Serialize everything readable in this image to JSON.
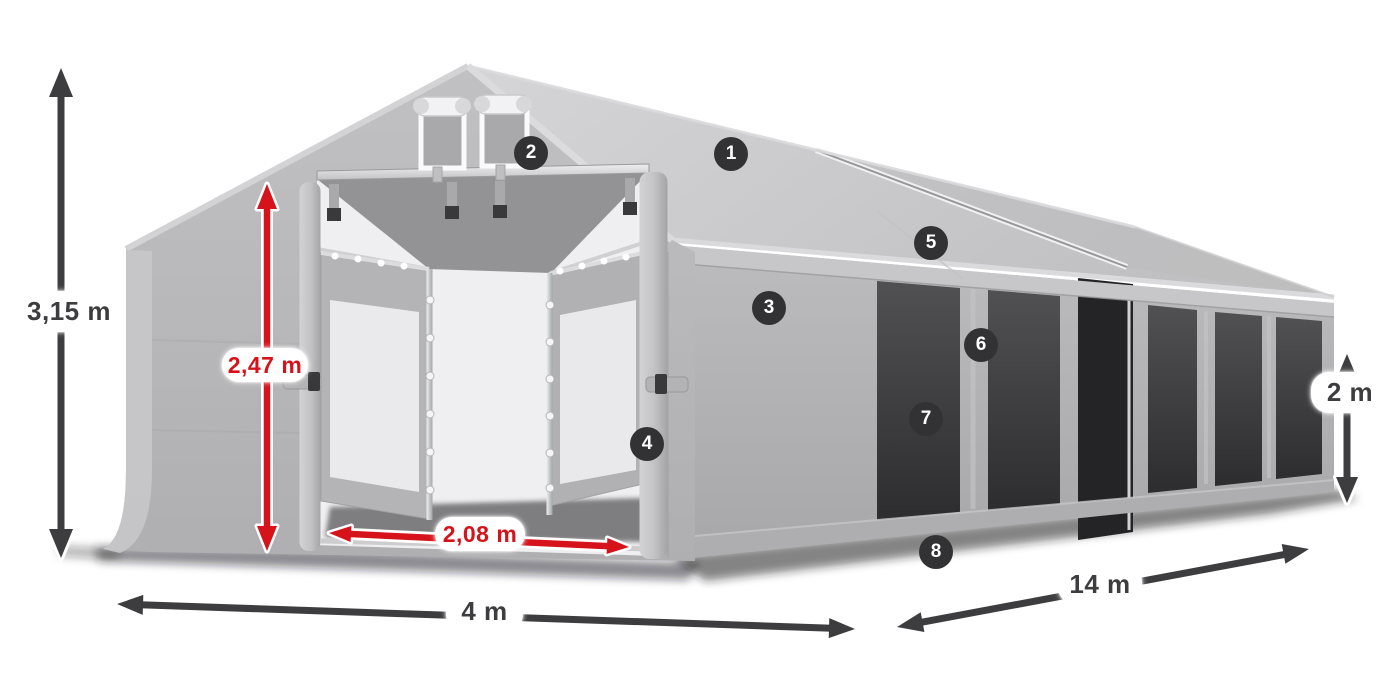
{
  "canvas": {
    "background": "#ffffff"
  },
  "colors": {
    "dimension_dark": "#3d3d3f",
    "dimension_red": "#d6121a",
    "pill_bg": "#ffffff",
    "badge_bg": "#323234",
    "badge_text": "#ffffff",
    "tent_fabric": "#b8b8ba",
    "mesh_window": "#38383a"
  },
  "dimensions": [
    {
      "id": "total-height",
      "label": "3,15 m",
      "color": "dark",
      "orientation": "vertical"
    },
    {
      "id": "entrance-height",
      "label": "2,47 m",
      "color": "red",
      "orientation": "vertical"
    },
    {
      "id": "entrance-width",
      "label": "2,08 m",
      "color": "red",
      "orientation": "horizontal"
    },
    {
      "id": "gable-width",
      "label": "4 m",
      "color": "dark",
      "orientation": "horizontal"
    },
    {
      "id": "length",
      "label": "14 m",
      "color": "dark",
      "orientation": "diagonal"
    },
    {
      "id": "sidewall-height",
      "label": "2 m",
      "color": "dark",
      "orientation": "vertical"
    }
  ],
  "badges": [
    {
      "number": "1"
    },
    {
      "number": "2"
    },
    {
      "number": "3"
    },
    {
      "number": "4"
    },
    {
      "number": "5"
    },
    {
      "number": "6"
    },
    {
      "number": "7"
    },
    {
      "number": "8"
    }
  ]
}
